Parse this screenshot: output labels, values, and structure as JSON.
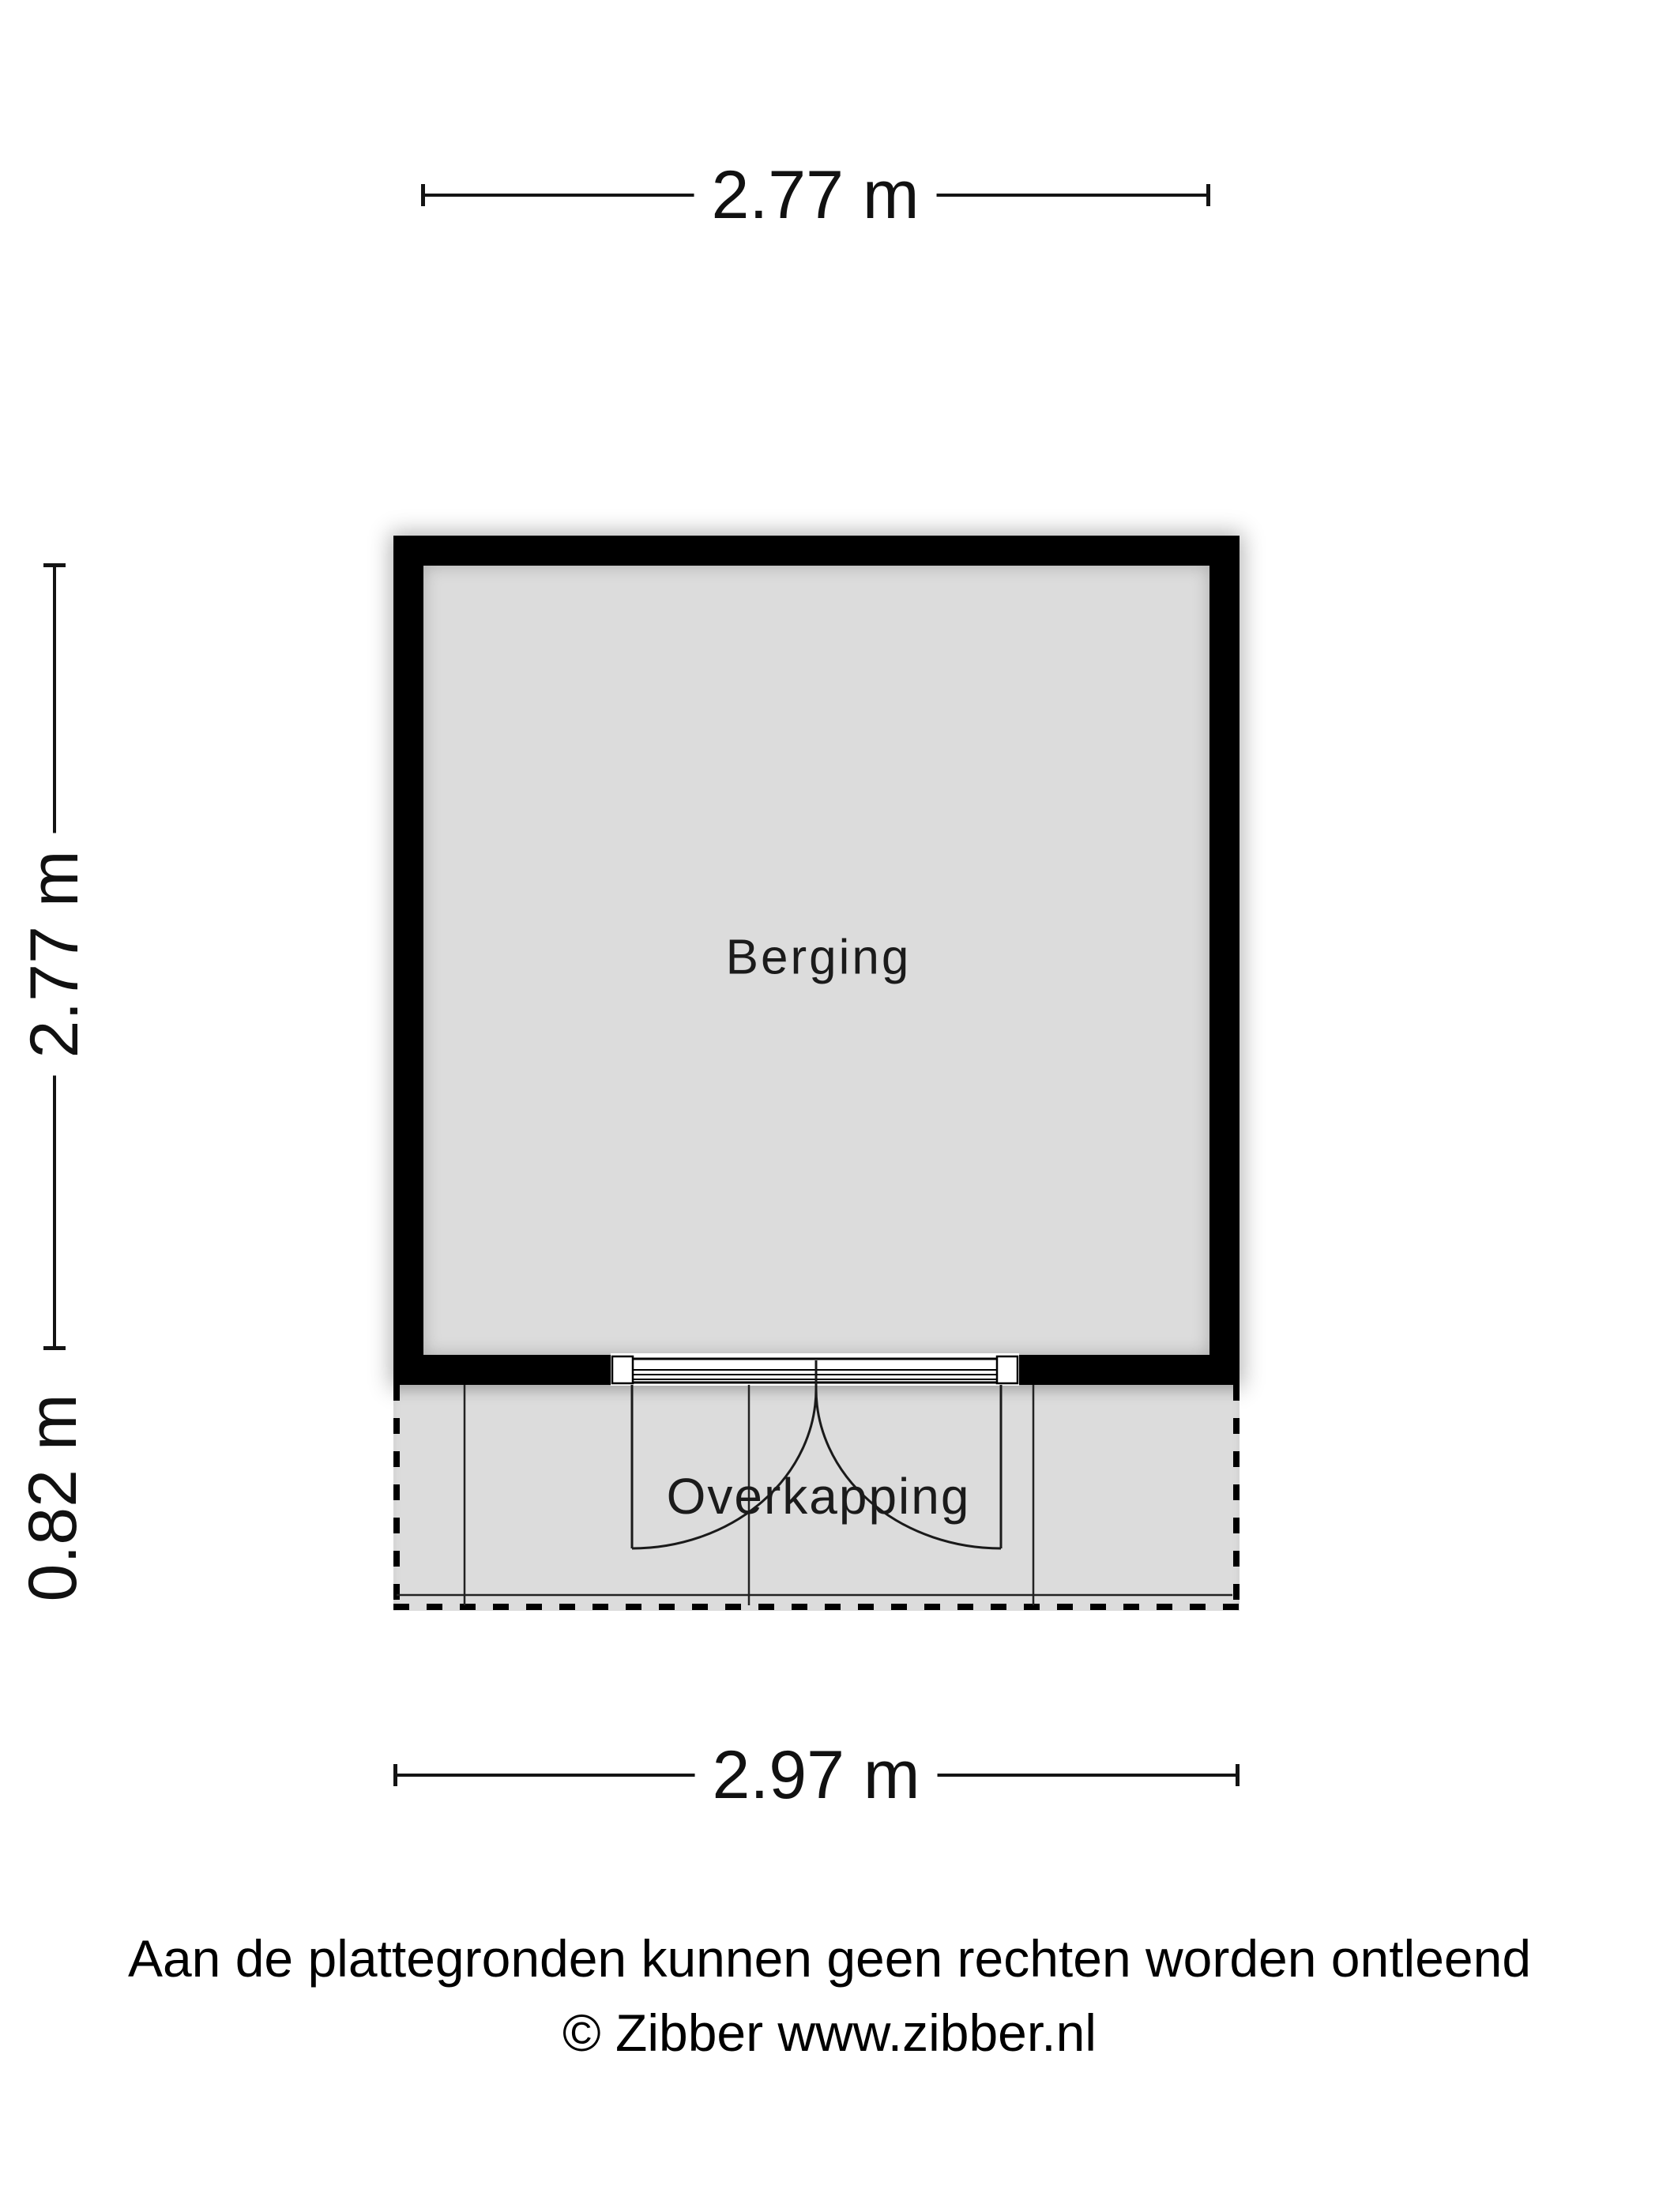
{
  "floorplan": {
    "rooms": [
      {
        "name": "Berging"
      },
      {
        "name": "Overkapping"
      }
    ],
    "dimensions": {
      "top": "2.77 m",
      "side_upper": "2.77 m",
      "side_lower": "0.82 m",
      "bottom": "2.97 m"
    },
    "colors": {
      "wall": "#000000",
      "floor": "#dcdcdc",
      "line": "#141414",
      "background": "#ffffff"
    }
  },
  "footer": {
    "disclaimer": "Aan de plattegronden kunnen geen rechten worden ontleend",
    "credit": "© Zibber www.zibber.nl"
  }
}
